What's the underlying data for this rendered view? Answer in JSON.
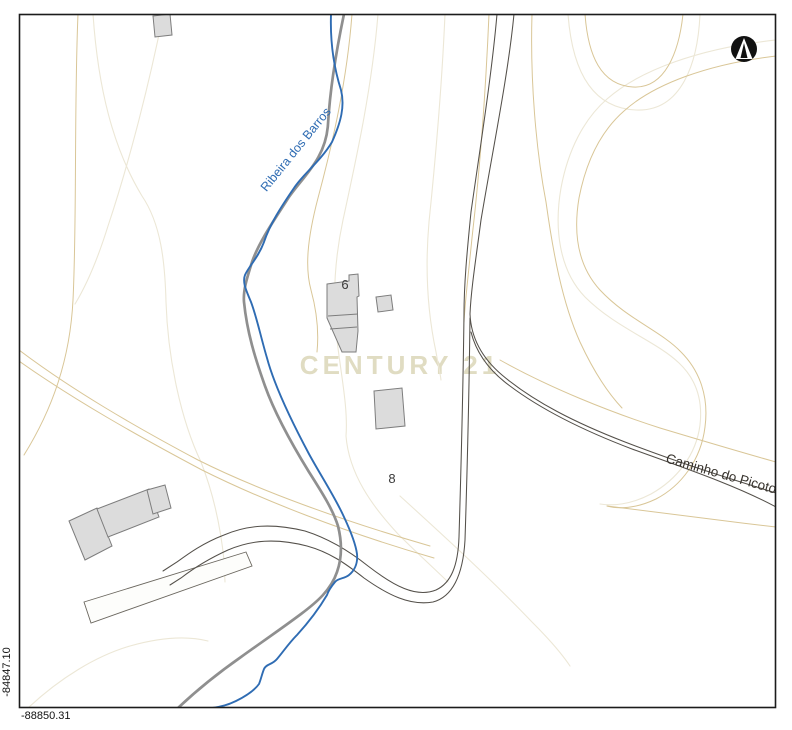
{
  "map": {
    "watermark": "CENTURY 21",
    "labels": {
      "stream": "Ribeira dos Barros",
      "road": "Caminho do Picoto",
      "house_number_a": "6",
      "house_number_b": "8"
    },
    "coordinates": {
      "y_axis": "-84847.10",
      "x_axis": "-88850.31"
    },
    "icons": {
      "north_arrow": "north-arrow-icon"
    },
    "colors": {
      "stream_blue": "#2f6cb3",
      "contour_tan": "#d9c697",
      "contour_cream": "#ece7d6",
      "road_dark": "#54504a",
      "road_thick_gray": "#8f8f8f",
      "building_fill": "#dcdcdc",
      "building_stroke": "#7d7d7d",
      "frame_black": "#1c1c1c",
      "watermark_beige": "#e0dcc2",
      "label_dark": "#38342e"
    }
  }
}
